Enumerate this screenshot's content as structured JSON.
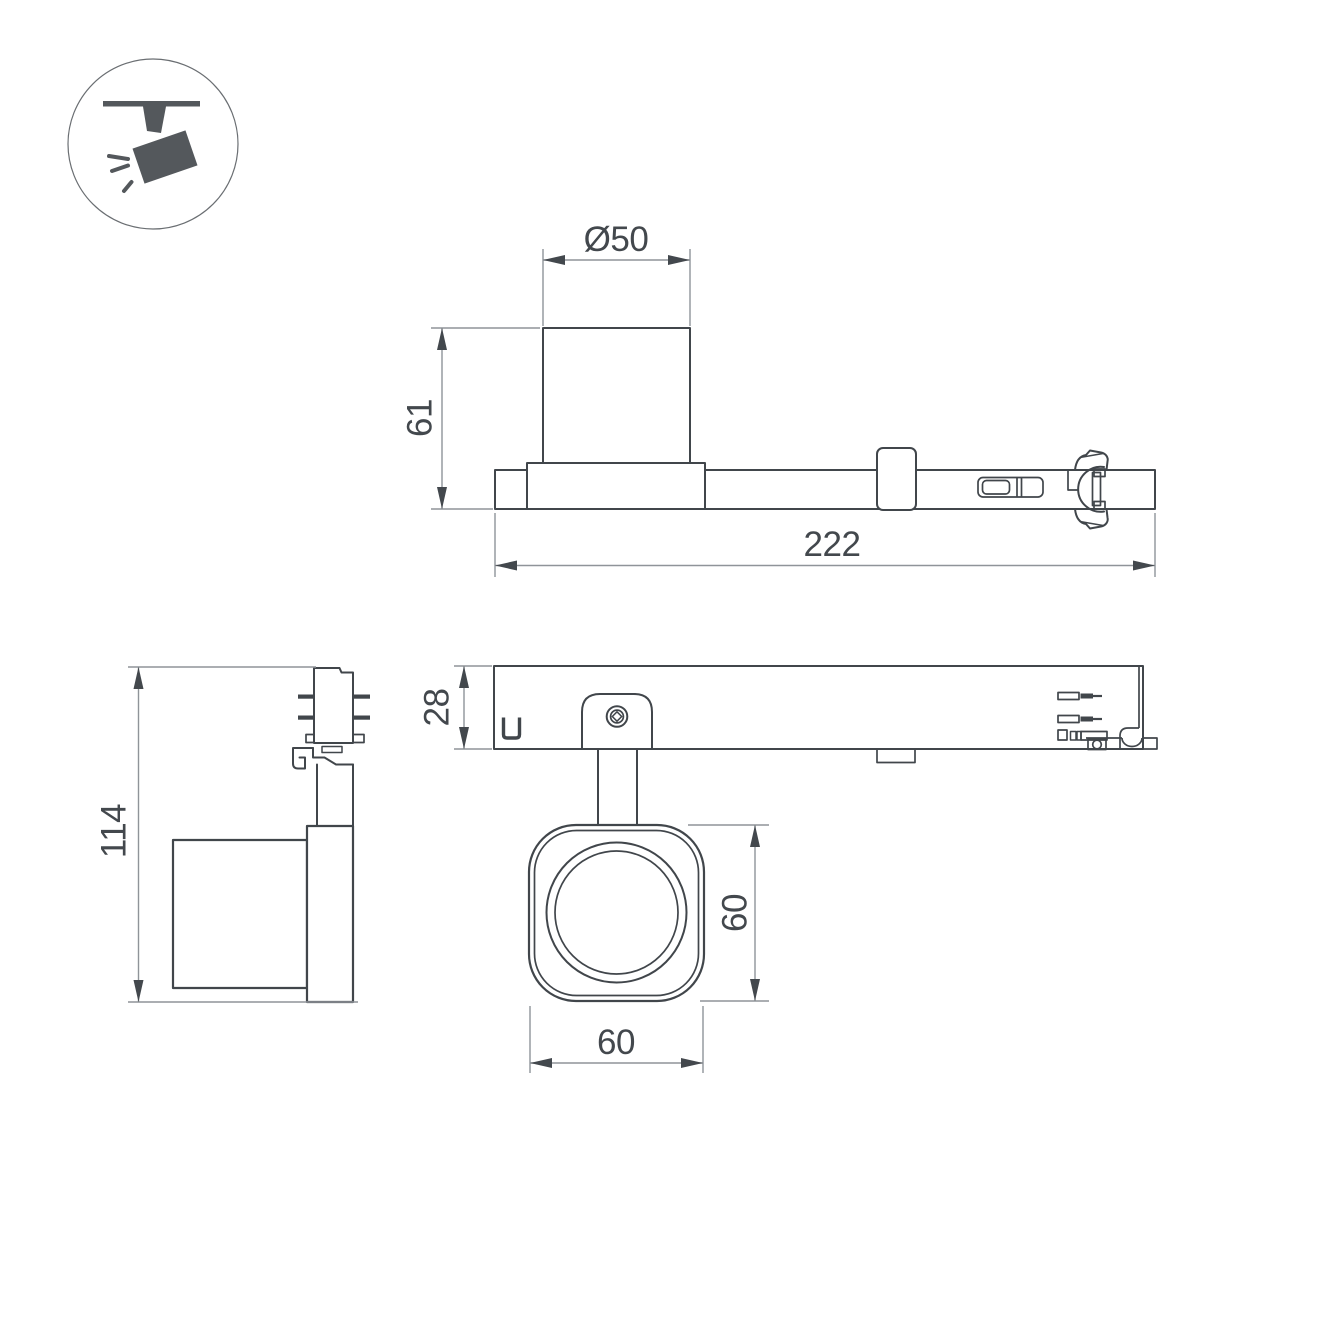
{
  "drawing": {
    "icon": {
      "name": "ceiling-track-spotlight-icon"
    },
    "dimensions": {
      "top_view": {
        "head_diameter": "Ø50",
        "head_height": "61",
        "total_length": "222"
      },
      "front_view": {
        "track_rail_height": "28",
        "head_face_width": "60",
        "head_face_height": "60"
      },
      "side_view": {
        "total_height": "114"
      }
    }
  },
  "colors": {
    "background": "#ffffff",
    "part_outline": "#41464b",
    "dimension_line": "#8f9499",
    "dimension_text": "#43484d",
    "icon_fill": "#54585c",
    "icon_circle_stroke": "#6a6e72"
  }
}
